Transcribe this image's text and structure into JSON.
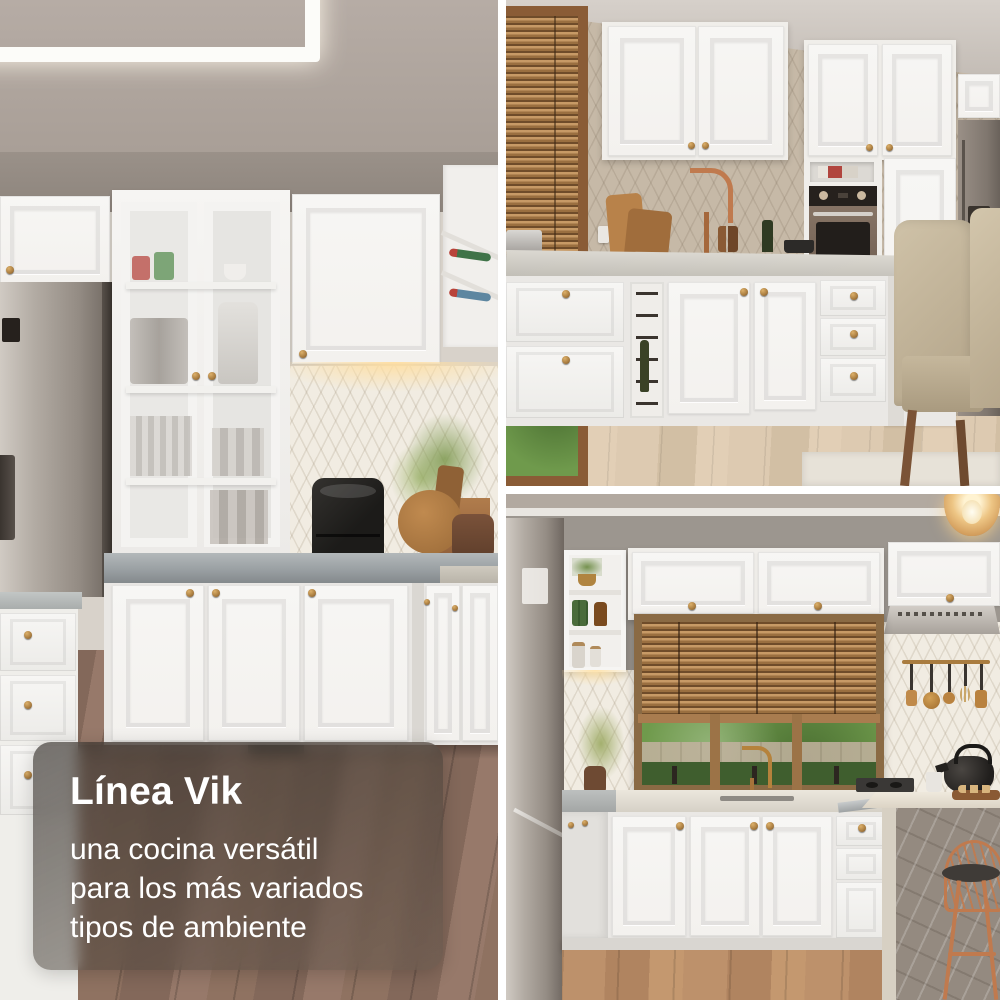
{
  "caption": {
    "title": "Línea Vik",
    "lines": [
      "una cocina versátil",
      "para los más variados",
      "tipos de ambiente"
    ]
  },
  "palette": {
    "background_gap": "#ffffff",
    "caption_text": "#ffffff",
    "caption_overlay": "#3e3832",
    "cabinet_white": "#f3f1ee",
    "brass_knob": "#a97c3f",
    "countertop_gray": "#9aa0a3",
    "stainless": "#a49d96",
    "wood_blinds": "#a5713f",
    "window_frame_wood": "#8a5c36",
    "greenery": "#6f9a4c",
    "copper_accent": "#c07a4e",
    "floor_left": "#8a6d5a",
    "floor_top_right": "#d8c6ae",
    "floor_bottom_right": "#b78c66"
  }
}
